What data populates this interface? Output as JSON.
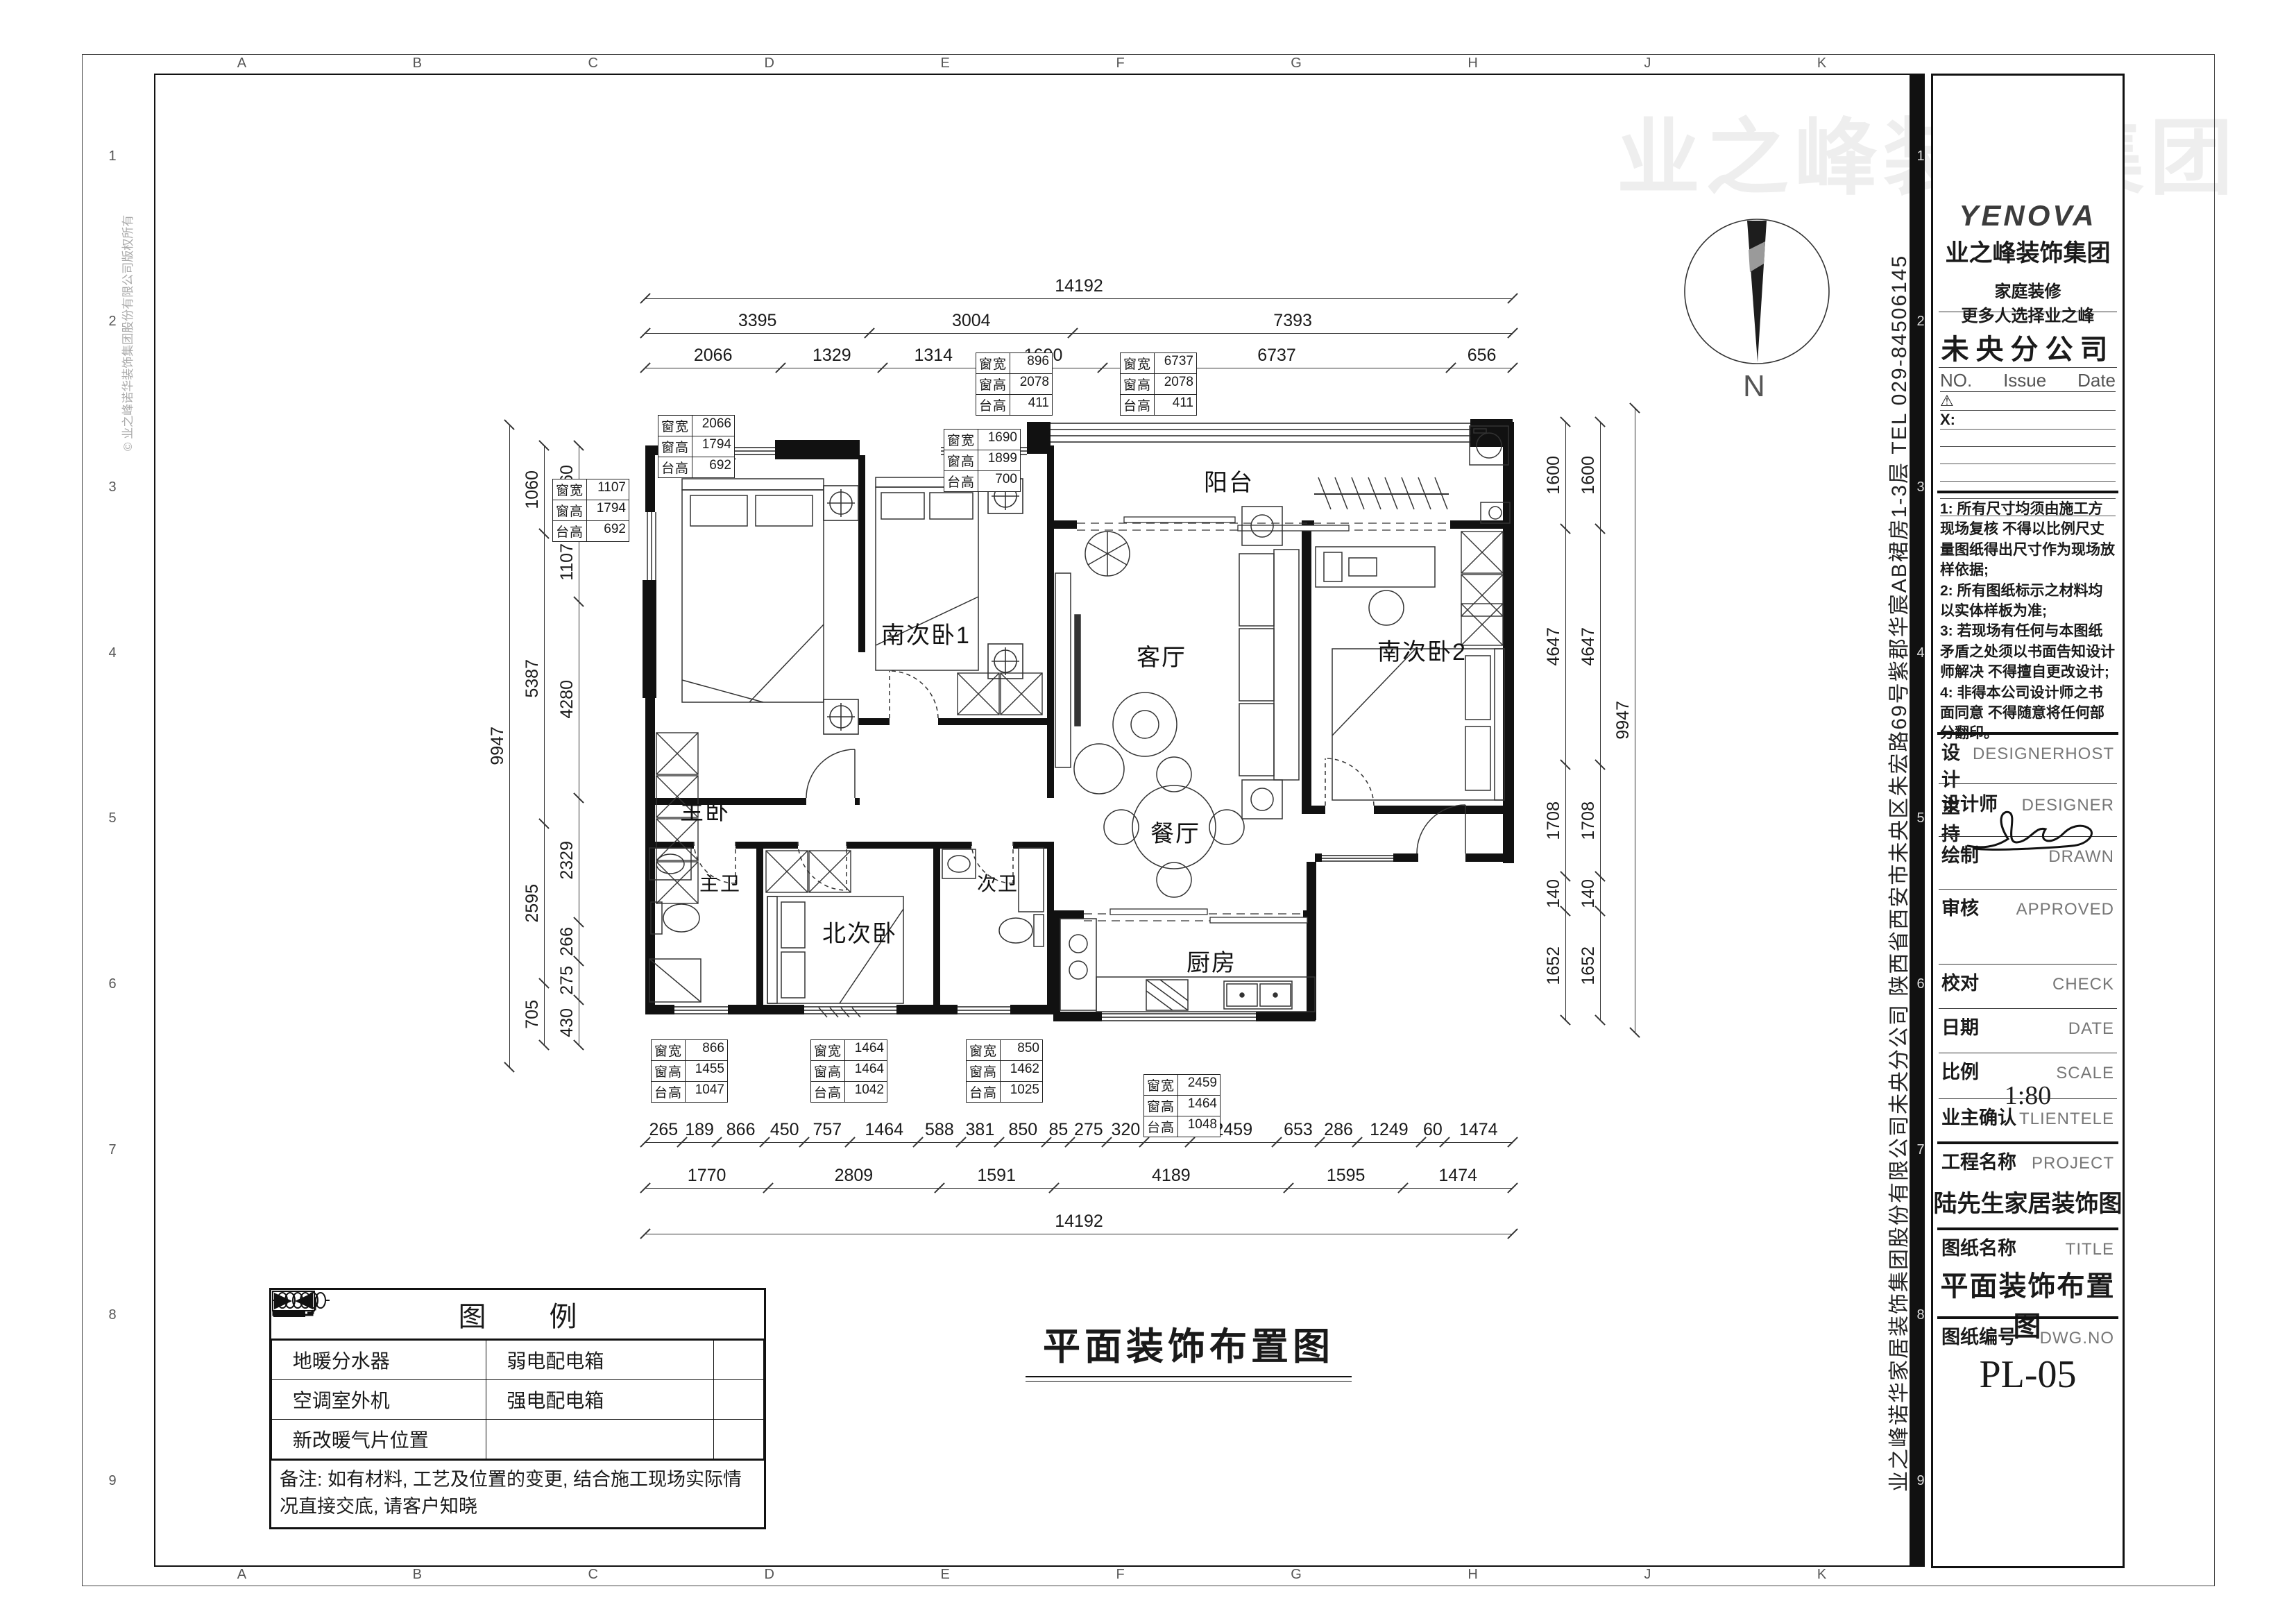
{
  "sheet": {
    "grid_letters": [
      "A",
      "B",
      "C",
      "D",
      "E",
      "F",
      "G",
      "H",
      "J",
      "K"
    ],
    "grid_numbers": [
      "1",
      "2",
      "3",
      "4",
      "5",
      "6",
      "7",
      "8",
      "9"
    ],
    "line_color": "#111111",
    "paper_color": "#ffffff"
  },
  "title_block": {
    "logo": {
      "brand": "YENOVA",
      "company": "业之峰装饰集团",
      "slogan1": "家庭装修",
      "slogan2": "更多人选择业之峰"
    },
    "branch": "未央分公司",
    "revision": {
      "no": "NO.",
      "issue": "Issue",
      "date": "Date",
      "warn": "⚠",
      "x_label": "X:"
    },
    "notes": [
      "1: 所有尺寸均须由施工方现场复核 不得以比例尺丈量图纸得出尺寸作为现场放样依据;",
      "2: 所有图纸标示之材料均以实体样板为准;",
      "3: 若现场有任何与本图纸矛盾之处须以书面告知设计师解决 不得擅自更改设计;",
      "4: 非得本公司设计师之书面同意 不得随意将任何部分翻印。"
    ],
    "fields": [
      {
        "cn": "设计主持",
        "en": "DESIGNERHOST"
      },
      {
        "cn": "设计师",
        "en": "DESIGNER"
      },
      {
        "cn": "绘制",
        "en": "DRAWN"
      },
      {
        "cn": "审核",
        "en": "APPROVED"
      },
      {
        "cn": "校对",
        "en": "CHECK"
      },
      {
        "cn": "日期",
        "en": "DATE"
      },
      {
        "cn": "比例",
        "en": "SCALE",
        "value": "1:80"
      },
      {
        "cn": "业主确认",
        "en": "TLIENTELE"
      },
      {
        "cn": "工程名称",
        "en": "PROJECT",
        "value": "陆先生家居装饰图"
      },
      {
        "cn": "图纸名称",
        "en": "TITLE",
        "value": "平面装饰布置图"
      },
      {
        "cn": "图纸编号",
        "en": "DWG.NO",
        "value": "PL-05"
      }
    ]
  },
  "side_text": {
    "company_address": "业之峰诺华家居装饰集团股份有限公司未央分公司  陕西省西安市未央区朱宏路69号紫郡华宸AB裙房1-3层  TEL 029-84506145",
    "copyright": "© 业之峰诺华装饰集团股份有限公司版权所有",
    "watermark": "业之峰装饰集团"
  },
  "plan": {
    "title": "平面装饰布置图",
    "compass_label": "N",
    "rooms": [
      {
        "id": "balcony",
        "label": "阳台"
      },
      {
        "id": "living",
        "label": "客厅"
      },
      {
        "id": "master-bedroom",
        "label": "主卧"
      },
      {
        "id": "south-bedroom-1",
        "label": "南次卧1"
      },
      {
        "id": "south-bedroom-2",
        "label": "南次卧2"
      },
      {
        "id": "dining",
        "label": "餐厅"
      },
      {
        "id": "kitchen",
        "label": "厨房"
      },
      {
        "id": "north-bedroom",
        "label": "北次卧"
      },
      {
        "id": "master-bath",
        "label": "主卫"
      },
      {
        "id": "second-bath",
        "label": "次卫"
      }
    ],
    "window_table_labels": [
      "窗宽",
      "窗高",
      "台高"
    ],
    "window_tables": [
      {
        "values": [
          "2066",
          "1794",
          "692"
        ]
      },
      {
        "values": [
          "1107",
          "1794",
          "692"
        ]
      },
      {
        "values": [
          "896",
          "2078",
          "411"
        ]
      },
      {
        "values": [
          "6737",
          "2078",
          "411"
        ]
      },
      {
        "values": [
          "1690",
          "1899",
          "700"
        ]
      },
      {
        "values": [
          "866",
          "1455",
          "1047"
        ]
      },
      {
        "values": [
          "1464",
          "1464",
          "1042"
        ]
      },
      {
        "values": [
          "850",
          "1462",
          "1025"
        ]
      },
      {
        "values": [
          "2459",
          "1464",
          "1048"
        ]
      }
    ],
    "dims": {
      "top_total": [
        "14192"
      ],
      "top_group": [
        "3395",
        "3004",
        "7393"
      ],
      "top_detail": [
        "2066",
        "1329",
        "1314",
        "1690",
        "6737",
        "656"
      ],
      "bottom_detail": [
        "265",
        "189",
        "866",
        "450",
        "757",
        "1464",
        "588",
        "381",
        "850",
        "85",
        "275",
        "320",
        "757",
        "2459",
        "653",
        "286",
        "1249",
        "60",
        "1474"
      ],
      "bottom_group": [
        "1770",
        "2809",
        "1591",
        "4189",
        "1595",
        "1474"
      ],
      "bottom_total": [
        "14192"
      ],
      "left_total": [
        "9947"
      ],
      "left_mid": [
        "1060",
        "5387",
        "2595",
        "705"
      ],
      "left_inner": [
        "1060",
        "1107",
        "4280",
        "2329",
        "266",
        "275",
        "430"
      ],
      "right_inner1": [
        "1600",
        "4647",
        "1708",
        "140",
        "1652"
      ],
      "right_inner2": [
        "1600",
        "4647",
        "1708",
        "140",
        "1652"
      ],
      "right_total": [
        "9947"
      ]
    }
  },
  "legend": {
    "title": "图  例",
    "items": [
      {
        "icon": "floor-heating-manifold-icon",
        "label": "地暖分水器"
      },
      {
        "icon": "weak-current-box-icon",
        "label": "弱电配电箱"
      },
      {
        "icon": "ac-outdoor-unit-icon",
        "label": "空调室外机"
      },
      {
        "icon": "strong-current-box-icon",
        "label": "强电配电箱"
      },
      {
        "icon": "new-radiator-position-icon",
        "label": "新改暖气片位置"
      }
    ],
    "note": "备注: 如有材料, 工艺及位置的变更, 结合施工现场实际情况直接交底, 请客户知晓"
  }
}
